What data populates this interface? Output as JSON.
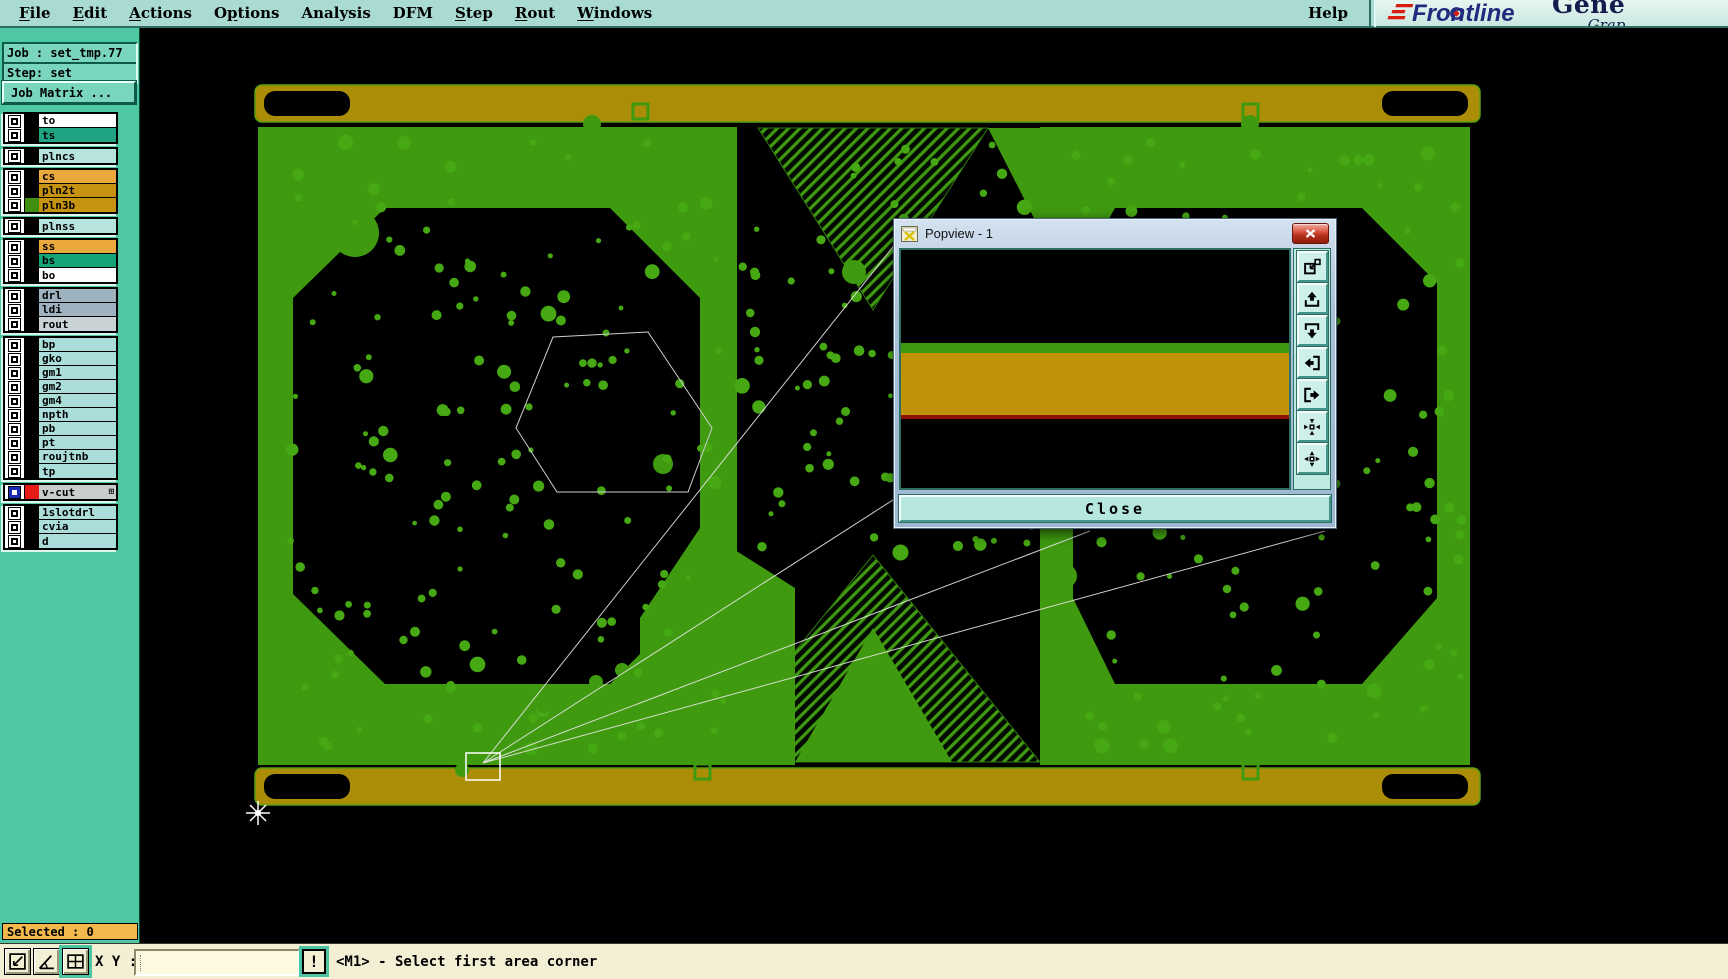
{
  "menu": {
    "items": [
      {
        "label": "File",
        "underline": 0
      },
      {
        "label": "Edit",
        "underline": 0
      },
      {
        "label": "Actions",
        "underline": 0
      },
      {
        "label": "Options",
        "underline": 1
      },
      {
        "label": "Analysis",
        "underline": -1
      },
      {
        "label": "DFM",
        "underline": -1
      },
      {
        "label": "Step",
        "underline": 0
      },
      {
        "label": "Rout",
        "underline": 0
      },
      {
        "label": "Windows",
        "underline": 0
      }
    ],
    "help": {
      "label": "Help"
    }
  },
  "logo": {
    "brand": "Frontline",
    "top_right": "Gene",
    "bottom_right": "Grap"
  },
  "sidebar": {
    "job": "Job : set_tmp.77",
    "step": "Step: set",
    "job_matrix": "Job Matrix ...",
    "selected": "Selected : 0",
    "layer_groups": [
      {
        "rows": [
          {
            "name": "to",
            "bg": "#fdfdfd",
            "chip": "#000000"
          },
          {
            "name": "ts",
            "bg": "#1fa382",
            "chip": "#000000"
          }
        ]
      },
      {
        "rows": [
          {
            "name": "plncs",
            "bg": "#b7e3de",
            "chip": "#000000"
          }
        ]
      },
      {
        "rows": [
          {
            "name": "cs",
            "bg": "#eaa83d",
            "chip": "#000000"
          },
          {
            "name": "pln2t",
            "bg": "#c69311",
            "chip": "#000000"
          },
          {
            "name": "pln3b",
            "bg": "#c69311",
            "chip": "#3f8f10"
          }
        ]
      },
      {
        "rows": [
          {
            "name": "plnss",
            "bg": "#b7e3de",
            "chip": "#000000"
          }
        ]
      },
      {
        "rows": [
          {
            "name": "ss",
            "bg": "#eaa83d",
            "chip": "#000000"
          },
          {
            "name": "bs",
            "bg": "#16a377",
            "chip": "#000000"
          },
          {
            "name": "bo",
            "bg": "#fdfdfd",
            "chip": "#000000"
          }
        ]
      },
      {
        "rows": [
          {
            "name": "drl",
            "bg": "#9fb2c0",
            "chip": "#000000"
          },
          {
            "name": "ldi",
            "bg": "#9fb2c0",
            "chip": "#000000"
          },
          {
            "name": "rout",
            "bg": "#c9d2d4",
            "chip": "#000000"
          }
        ]
      },
      {
        "rows": [
          {
            "name": "bp",
            "bg": "#abdedb",
            "chip": "#000000"
          },
          {
            "name": "gko",
            "bg": "#abdedb",
            "chip": "#000000"
          },
          {
            "name": "gm1",
            "bg": "#abdedb",
            "chip": "#000000"
          },
          {
            "name": "gm2",
            "bg": "#abdedb",
            "chip": "#000000"
          },
          {
            "name": "gm4",
            "bg": "#abdedb",
            "chip": "#000000"
          },
          {
            "name": "npth",
            "bg": "#abdedb",
            "chip": "#000000"
          },
          {
            "name": "pb",
            "bg": "#abdedb",
            "chip": "#000000"
          },
          {
            "name": "pt",
            "bg": "#abdedb",
            "chip": "#000000"
          },
          {
            "name": "roujtnb",
            "bg": "#abdedb",
            "chip": "#000000"
          },
          {
            "name": "tp",
            "bg": "#abdedb",
            "chip": "#000000"
          }
        ]
      },
      {
        "rows": [
          {
            "name": "v-cut",
            "bg": "#c9cdc9",
            "chip": "#e51c17",
            "checkbox": "blue",
            "expand": "⊞"
          }
        ]
      },
      {
        "rows": [
          {
            "name": "1slotdrl",
            "bg": "#abdedb",
            "chip": "#000000"
          },
          {
            "name": "cvia",
            "bg": "#abdedb",
            "chip": "#000000"
          },
          {
            "name": "d",
            "bg": "#abdedb",
            "chip": "#000000"
          }
        ]
      }
    ]
  },
  "popview": {
    "title": "Popview - 1",
    "close_label": "Close",
    "tools": [
      "open-new-popview-icon",
      "pan-up-icon",
      "pan-down-icon",
      "pan-left-icon",
      "pan-right-icon",
      "zoom-center-icon",
      "zoom-fit-icon"
    ],
    "view_bands": {
      "black": "#000000",
      "green": "#3f9a10",
      "gold": "#c09208",
      "red": "#8e1206"
    }
  },
  "statusbar": {
    "xy_label": "X Y :",
    "input_value": "",
    "alert_label": "!",
    "message": "<M1> - Select first area corner",
    "buttons": [
      "area-select-icon",
      "measure-angle-icon",
      "grid-icon"
    ]
  },
  "colors": {
    "menu_bg": "#a9dbd3",
    "sidebar_bg": "#4ec7a3",
    "pcb_green": "#3f9a10",
    "rail_gold": "#ab8d07",
    "selected_bg": "#f2b84b",
    "statusbar_bg": "#f3efd4"
  }
}
